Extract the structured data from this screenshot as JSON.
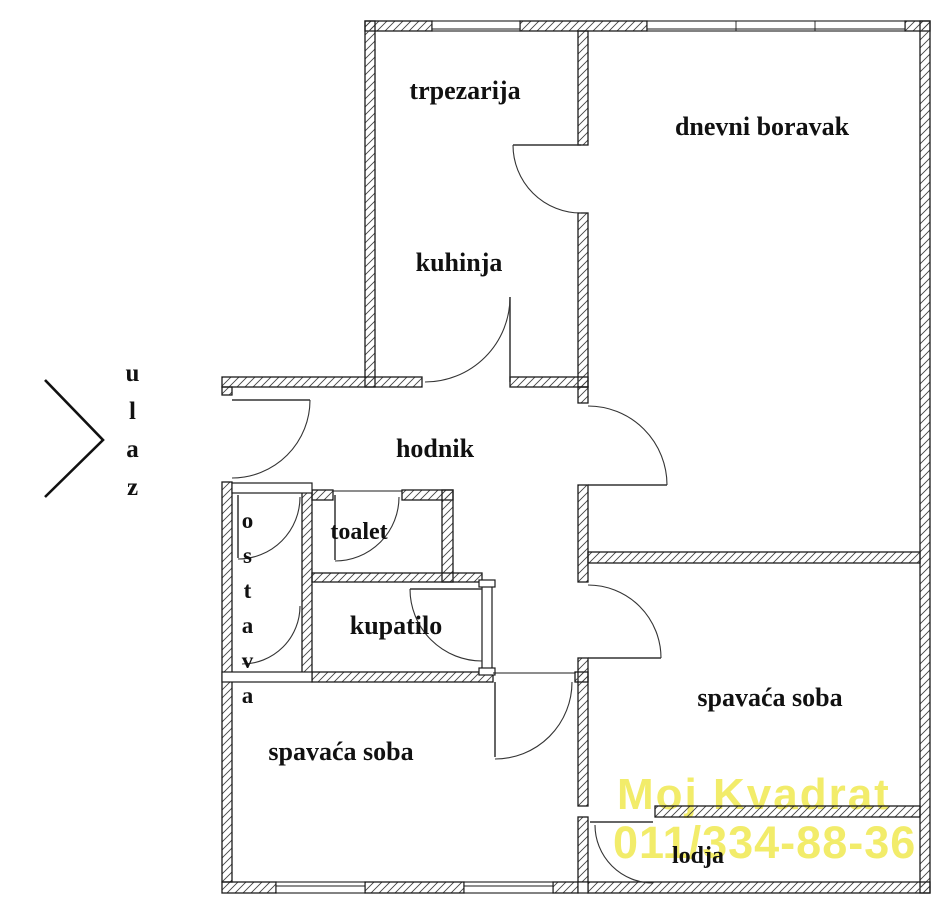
{
  "labels": {
    "trpezarija": "trpezarija",
    "dnevni_boravak": "dnevni boravak",
    "kuhinja": "kuhinja",
    "hodnik": "hodnik",
    "toalet": "toalet",
    "kupatilo": "kupatilo",
    "ostava": "ostava",
    "spavaca_soba_left": "spavaća soba",
    "spavaca_soba_right": "spavaća soba",
    "lodja": "lodja",
    "ulaz": "ulaz"
  },
  "watermark": {
    "brand": "Moj Kvadrat",
    "phone": "011/334-88-36",
    "color": "#f2ec6a"
  },
  "colors": {
    "wall_line": "#1b1b1b",
    "hatch_line": "#444444",
    "door_line": "#333333",
    "text": "#111111",
    "background": "#ffffff"
  }
}
